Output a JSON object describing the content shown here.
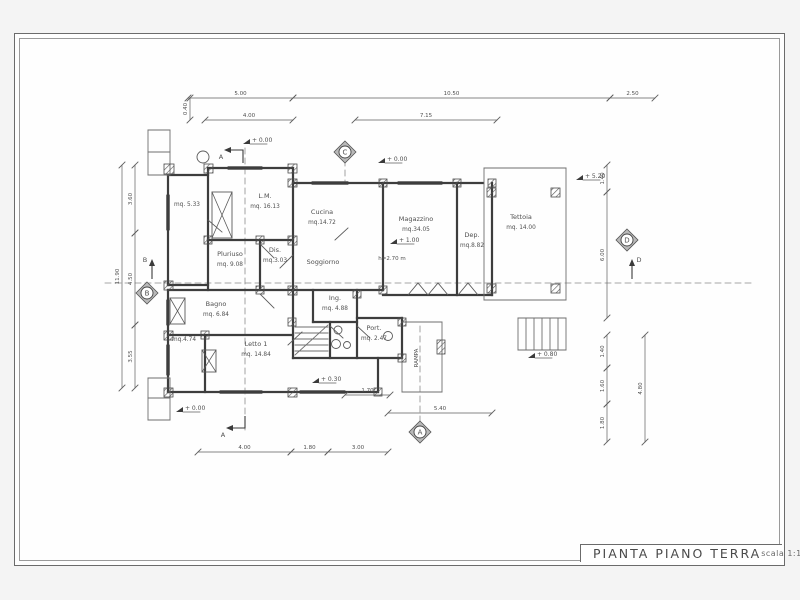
{
  "sheet": {
    "title": "PIANTA PIANO TERRA",
    "scale_label": "scala 1:100"
  },
  "colors": {
    "wall": "#3d3d3d",
    "line": "#5a5a5a",
    "thin": "#6e6e6e",
    "text": "#4f4f4f",
    "dim": "#5f5f5f"
  },
  "plan": {
    "rooms": [
      {
        "name": "",
        "area": "mq. 5.33",
        "x": 187,
        "y": 206
      },
      {
        "name": "L.M.",
        "area": "mq. 16.13",
        "x": 265,
        "y": 198
      },
      {
        "name": "Cucina",
        "area": "mq.14.72",
        "x": 322,
        "y": 214
      },
      {
        "name": "Soggiorno",
        "area": "",
        "x": 323,
        "y": 264
      },
      {
        "name": "Magazzino",
        "area": "mq.34.05",
        "x": 416,
        "y": 221
      },
      {
        "name": "Dep.",
        "area": "mq.8.82",
        "x": 472,
        "y": 237
      },
      {
        "name": "Tettoia",
        "area": "mq. 14.00",
        "x": 521,
        "y": 219
      },
      {
        "name": "Pluriuso",
        "area": "mq. 9.08",
        "x": 230,
        "y": 256
      },
      {
        "name": "Dis.",
        "area": "mq.3.03",
        "x": 275,
        "y": 252
      },
      {
        "name": "Bagno",
        "area": "mq. 6.84",
        "x": 216,
        "y": 306
      },
      {
        "name": "",
        "area": "mq.4.74",
        "x": 184,
        "y": 341
      },
      {
        "name": "Letto 1",
        "area": "mq. 14.84",
        "x": 256,
        "y": 346
      },
      {
        "name": "Ing.",
        "area": "mq. 4.88",
        "x": 335,
        "y": 300
      },
      {
        "name": "Port.",
        "area": "mq. 2.47",
        "x": 374,
        "y": 330
      }
    ],
    "extra_texts": [
      {
        "text": "h=2.70 m",
        "x": 392,
        "y": 260,
        "size": 5.5,
        "rot": 0
      },
      {
        "text": "RAMPA",
        "x": 418,
        "y": 358,
        "size": 5.5,
        "rot": -90
      },
      {
        "text": "mq. 14.84 note",
        "x": -100,
        "y": -100,
        "size": 0,
        "rot": 0
      }
    ],
    "levels": [
      {
        "label": "+ 0.00",
        "x": 243,
        "y": 142
      },
      {
        "label": "+ 0.00",
        "x": 378,
        "y": 161
      },
      {
        "label": "+ 5.20",
        "x": 576,
        "y": 178
      },
      {
        "label": "+ 1.00",
        "x": 390,
        "y": 242
      },
      {
        "label": "+ 0.30",
        "x": 312,
        "y": 381
      },
      {
        "label": "+ 0.80",
        "x": 528,
        "y": 356
      },
      {
        "label": "+ 0.00",
        "x": 176,
        "y": 410
      }
    ],
    "sections": [
      {
        "letter": "C",
        "x": 345,
        "y": 152
      },
      {
        "letter": "B",
        "x": 147,
        "y": 293
      },
      {
        "letter": "D",
        "x": 627,
        "y": 240
      },
      {
        "letter": "A",
        "x": 420,
        "y": 432
      }
    ],
    "section_arrows": [
      {
        "label": "A",
        "pts": [
          [
            243,
            163
          ],
          [
            243,
            150
          ],
          [
            230,
            150
          ]
        ],
        "head": "left",
        "lx": 221,
        "ly": 159
      },
      {
        "label": "A",
        "pts": [
          [
            245,
            416
          ],
          [
            245,
            428
          ],
          [
            232,
            428
          ]
        ],
        "head": "left",
        "lx": 223,
        "ly": 437
      },
      {
        "label": "B",
        "pts": [
          [
            152,
            279
          ],
          [
            152,
            265
          ]
        ],
        "head": "up",
        "lx": 145,
        "ly": 262
      },
      {
        "label": "D",
        "pts": [
          [
            632,
            279
          ],
          [
            632,
            265
          ]
        ],
        "head": "up",
        "lx": 639,
        "ly": 262
      }
    ],
    "dims_h": [
      {
        "y": 98,
        "x1": 188,
        "x2": 293,
        "label": "5.00"
      },
      {
        "y": 98,
        "x1": 293,
        "x2": 610,
        "label": "10.50"
      },
      {
        "y": 98,
        "x1": 610,
        "x2": 655,
        "label": "2.50"
      },
      {
        "y": 120,
        "x1": 205,
        "x2": 293,
        "label": "4.00"
      },
      {
        "y": 120,
        "x1": 355,
        "x2": 497,
        "label": "7.15"
      },
      {
        "y": 452,
        "x1": 198,
        "x2": 291,
        "label": "4.00"
      },
      {
        "y": 452,
        "x1": 291,
        "x2": 328,
        "label": "1.80"
      },
      {
        "y": 452,
        "x1": 328,
        "x2": 388,
        "label": "3.00"
      },
      {
        "y": 413,
        "x1": 388,
        "x2": 492,
        "label": "5.40"
      },
      {
        "y": 395,
        "x1": 345,
        "x2": 390,
        "label": "1.70"
      }
    ],
    "dims_v": [
      {
        "x": 122,
        "y1": 165,
        "y2": 388,
        "label": "11.90"
      },
      {
        "x": 135,
        "y1": 165,
        "y2": 233,
        "label": "3.60"
      },
      {
        "x": 135,
        "y1": 233,
        "y2": 325,
        "label": "4.50"
      },
      {
        "x": 135,
        "y1": 325,
        "y2": 388,
        "label": "3.55"
      },
      {
        "x": 190,
        "y1": 98,
        "y2": 120,
        "label": "0.40"
      },
      {
        "x": 607,
        "y1": 165,
        "y2": 192,
        "label": "1.40"
      },
      {
        "x": 607,
        "y1": 192,
        "y2": 318,
        "label": "6.00"
      },
      {
        "x": 607,
        "y1": 335,
        "y2": 368,
        "label": "1.40"
      },
      {
        "x": 607,
        "y1": 368,
        "y2": 404,
        "label": "1.60"
      },
      {
        "x": 607,
        "y1": 404,
        "y2": 442,
        "label": "1.80"
      },
      {
        "x": 645,
        "y1": 335,
        "y2": 442,
        "label": "4.80"
      }
    ],
    "walls": [
      [
        208,
        168,
        293,
        168
      ],
      [
        168,
        175,
        208,
        175
      ],
      [
        168,
        175,
        168,
        285
      ],
      [
        208,
        168,
        208,
        240
      ],
      [
        293,
        168,
        293,
        183
      ],
      [
        208,
        240,
        293,
        240
      ],
      [
        168,
        285,
        208,
        285
      ],
      [
        208,
        240,
        208,
        290
      ],
      [
        260,
        240,
        260,
        290
      ],
      [
        168,
        290,
        293,
        290
      ],
      [
        168,
        290,
        168,
        392
      ],
      [
        168,
        335,
        293,
        335
      ],
      [
        205,
        335,
        205,
        392
      ],
      [
        168,
        392,
        378,
        392
      ],
      [
        378,
        358,
        378,
        392
      ],
      [
        293,
        183,
        483,
        183
      ],
      [
        293,
        183,
        293,
        290
      ],
      [
        383,
        183,
        383,
        290
      ],
      [
        293,
        290,
        383,
        290
      ],
      [
        457,
        183,
        457,
        295
      ],
      [
        492,
        183,
        492,
        295
      ],
      [
        383,
        295,
        492,
        295
      ],
      [
        293,
        290,
        293,
        358
      ],
      [
        293,
        358,
        402,
        358
      ],
      [
        313,
        290,
        313,
        322
      ],
      [
        357,
        290,
        357,
        358
      ],
      [
        313,
        322,
        357,
        322
      ],
      [
        330,
        322,
        330,
        358
      ],
      [
        357,
        318,
        402,
        318
      ],
      [
        402,
        318,
        402,
        358
      ]
    ],
    "thin": [
      [
        484,
        168,
        566,
        168
      ],
      [
        566,
        168,
        566,
        300
      ],
      [
        484,
        300,
        566,
        300
      ],
      [
        484,
        168,
        484,
        300
      ],
      [
        442,
        322,
        442,
        392
      ],
      [
        402,
        392,
        442,
        392
      ],
      [
        402,
        358,
        402,
        392
      ],
      [
        402,
        322,
        442,
        322
      ],
      [
        518,
        318,
        566,
        318
      ],
      [
        518,
        350,
        566,
        350
      ],
      [
        518,
        318,
        518,
        350
      ],
      [
        566,
        318,
        566,
        350
      ],
      [
        526,
        318,
        526,
        350
      ],
      [
        534,
        318,
        534,
        350
      ],
      [
        542,
        318,
        542,
        350
      ],
      [
        550,
        318,
        550,
        350
      ],
      [
        558,
        318,
        558,
        350
      ],
      [
        148,
        130,
        170,
        130
      ],
      [
        148,
        130,
        148,
        175
      ],
      [
        148,
        152,
        170,
        152
      ],
      [
        148,
        175,
        170,
        175
      ],
      [
        170,
        130,
        170,
        175
      ],
      [
        148,
        378,
        170,
        378
      ],
      [
        148,
        378,
        148,
        420
      ],
      [
        148,
        398,
        170,
        398
      ],
      [
        148,
        420,
        170,
        420
      ],
      [
        170,
        378,
        170,
        420
      ],
      [
        295,
        327,
        328,
        327
      ],
      [
        295,
        333,
        328,
        333
      ],
      [
        295,
        339,
        328,
        339
      ],
      [
        295,
        345,
        328,
        345
      ],
      [
        295,
        351,
        328,
        351
      ],
      [
        295,
        355,
        328,
        325
      ]
    ],
    "dashed": [
      [
        105,
        283,
        755,
        283
      ],
      [
        245,
        148,
        245,
        430
      ],
      [
        420,
        326,
        420,
        426
      ],
      [
        345,
        160,
        345,
        182
      ]
    ],
    "windows": [
      {
        "o": "h",
        "x1": 228,
        "x2": 262,
        "y": 168
      },
      {
        "o": "h",
        "x1": 312,
        "x2": 348,
        "y": 183
      },
      {
        "o": "h",
        "x1": 398,
        "x2": 442,
        "y": 183
      },
      {
        "o": "v",
        "y1": 195,
        "y2": 230,
        "x": 168
      },
      {
        "o": "v",
        "y1": 300,
        "y2": 325,
        "x": 168
      },
      {
        "o": "v",
        "y1": 345,
        "y2": 375,
        "x": 168
      },
      {
        "o": "h",
        "x1": 220,
        "x2": 262,
        "y": 392
      },
      {
        "o": "h",
        "x1": 300,
        "x2": 345,
        "y": 392
      }
    ],
    "piers": [
      [
        164,
        164,
        10,
        10
      ],
      [
        204,
        164,
        9,
        9
      ],
      [
        288,
        164,
        9,
        9
      ],
      [
        288,
        179,
        9,
        8
      ],
      [
        379,
        179,
        8,
        8
      ],
      [
        453,
        179,
        8,
        8
      ],
      [
        488,
        179,
        8,
        8
      ],
      [
        204,
        236,
        8,
        8
      ],
      [
        256,
        236,
        8,
        8
      ],
      [
        288,
        236,
        9,
        9
      ],
      [
        164,
        281,
        9,
        9
      ],
      [
        256,
        286,
        8,
        8
      ],
      [
        288,
        286,
        9,
        9
      ],
      [
        164,
        331,
        9,
        9
      ],
      [
        201,
        331,
        8,
        8
      ],
      [
        164,
        388,
        9,
        9
      ],
      [
        288,
        388,
        9,
        9
      ],
      [
        374,
        388,
        8,
        8
      ],
      [
        288,
        318,
        8,
        8
      ],
      [
        398,
        318,
        8,
        8
      ],
      [
        398,
        354,
        8,
        8
      ],
      [
        437,
        340,
        8,
        14
      ],
      [
        487,
        188,
        9,
        9
      ],
      [
        551,
        188,
        9,
        9
      ],
      [
        487,
        284,
        9,
        9
      ],
      [
        551,
        284,
        9,
        9
      ],
      [
        353,
        290,
        8,
        8
      ],
      [
        379,
        286,
        8,
        8
      ]
    ],
    "xboxes": [
      [
        212,
        192,
        20,
        46
      ],
      [
        170,
        298,
        15,
        26
      ],
      [
        202,
        350,
        14,
        22
      ]
    ],
    "circles": [
      [
        203,
        157,
        6
      ],
      [
        338,
        330,
        4
      ],
      [
        336,
        344,
        4.5
      ],
      [
        347,
        345,
        3.5
      ],
      [
        388,
        336,
        4.5
      ]
    ],
    "vees": [
      [
        [
          408,
          295
        ],
        [
          418,
          283
        ],
        [
          428,
          295
        ]
      ],
      [
        [
          428,
          295
        ],
        [
          438,
          283
        ],
        [
          448,
          295
        ]
      ],
      [
        [
          458,
          295
        ],
        [
          468,
          283
        ],
        [
          478,
          295
        ]
      ]
    ],
    "doors": [
      [
        260,
        244,
        274,
        258
      ],
      [
        293,
        255,
        280,
        268
      ],
      [
        260,
        294,
        274,
        308
      ],
      [
        288,
        345,
        302,
        332
      ],
      [
        335,
        240,
        348,
        228
      ],
      [
        208,
        220,
        222,
        232
      ],
      [
        330,
        326,
        343,
        338
      ],
      [
        357,
        326,
        370,
        338
      ]
    ]
  }
}
